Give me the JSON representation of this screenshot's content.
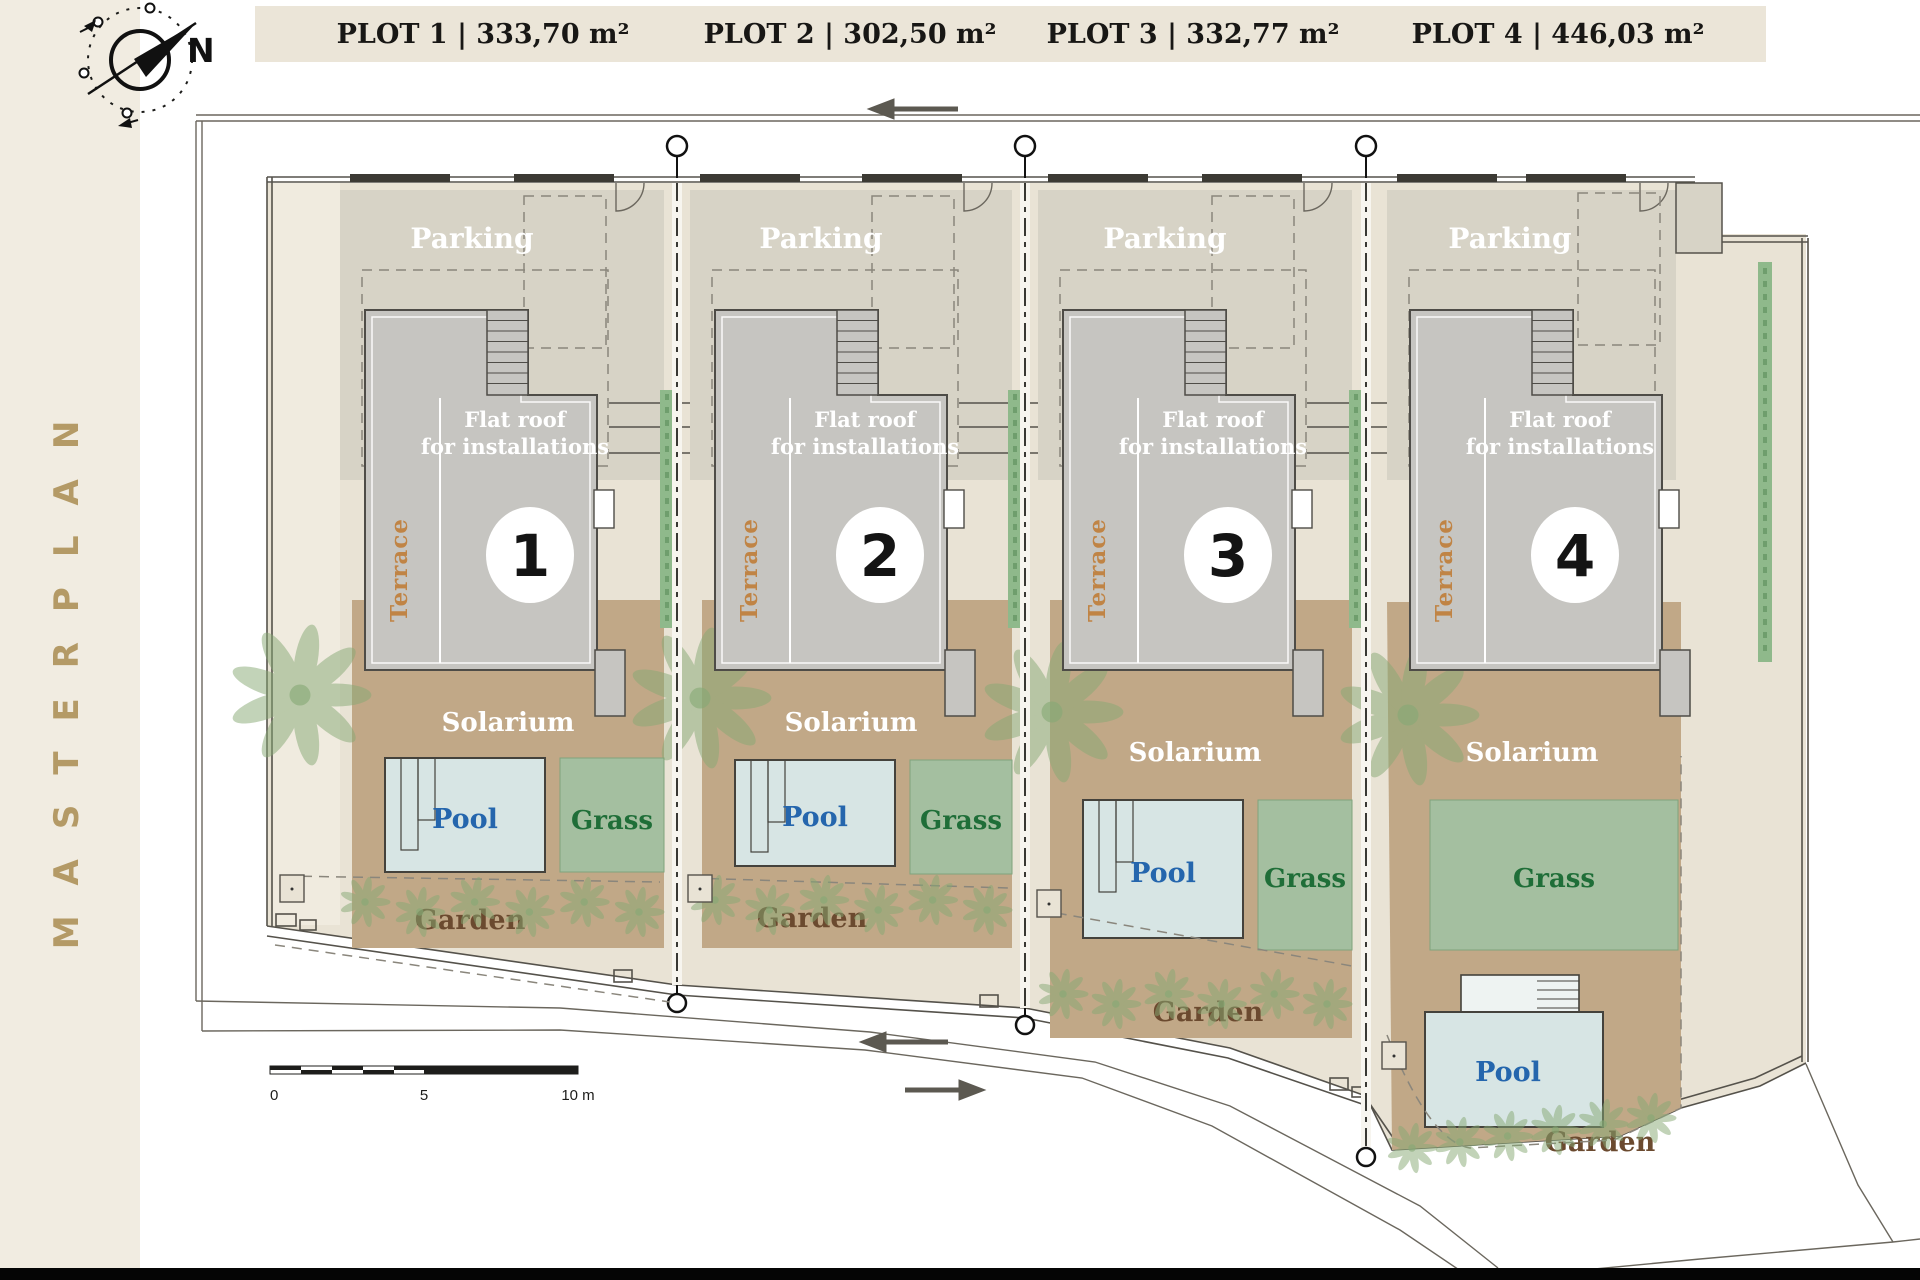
{
  "sidebar": {
    "title": "MASTERPLAN"
  },
  "compass": {
    "north_label": "N"
  },
  "header": {
    "plots": [
      {
        "label": "PLOT 1 | 333,70 m²"
      },
      {
        "label": "PLOT 2 | 302,50 m²"
      },
      {
        "label": "PLOT 3 | 332,77 m²"
      },
      {
        "label": "PLOT 4 | 446,03 m²"
      }
    ]
  },
  "labels": {
    "parking": "Parking",
    "flat_roof_line1": "Flat roof",
    "flat_roof_line2": "for installations",
    "terrace": "Terrace",
    "solarium": "Solarium",
    "pool": "Pool",
    "grass": "Grass",
    "garden": "Garden"
  },
  "villas": [
    {
      "number": "1"
    },
    {
      "number": "2"
    },
    {
      "number": "3"
    },
    {
      "number": "4"
    }
  ],
  "scale_bar": {
    "ticks": [
      "0",
      "5",
      "10 m"
    ]
  },
  "colors": {
    "sidebar_fill": "#f1ece1",
    "header_fill": "#ebe5d8",
    "brand_gold": "#b49a66",
    "plot_fill": "#e9e3d5",
    "entry_strip_fill": "#f0ebdf",
    "parking_fill": "#d7d3c6",
    "building_fill": "#c6c5c1",
    "building_stroke": "#4e4c47",
    "solarium_fill": "#c1a887",
    "pool_fill": "#d7e5e4",
    "pool_text": "#2566ad",
    "grass_fill": "#a4bfa0",
    "grass_text": "#1f6e38",
    "garden_text": "#6b4a2f",
    "terrace_text": "#c08445",
    "hedge_fill": "#8fb98b",
    "palm_green": "#86a874"
  }
}
